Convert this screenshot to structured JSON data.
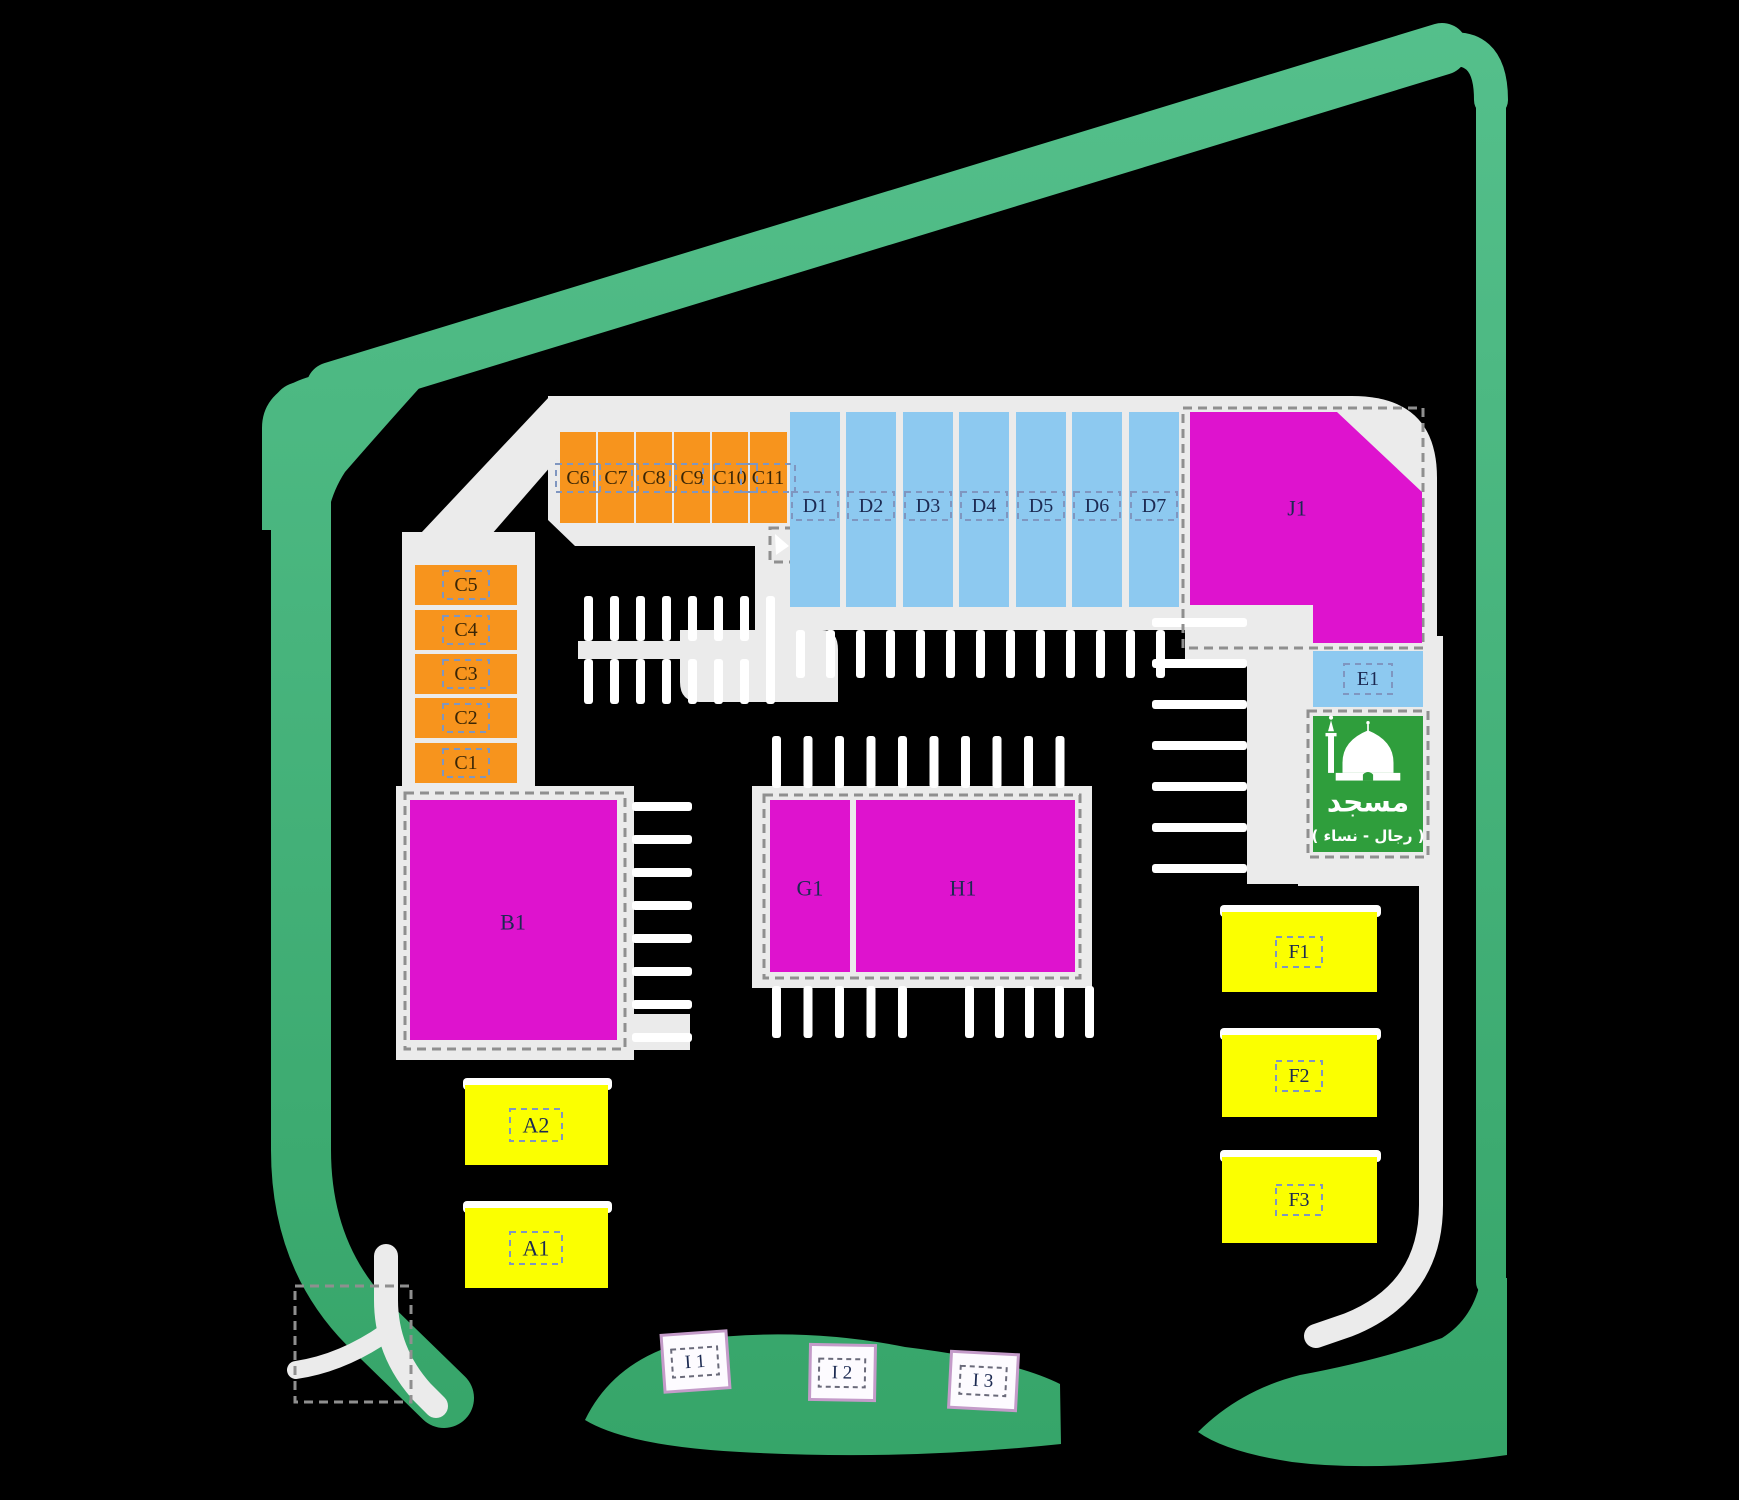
{
  "title": "Commercial plaza site plan",
  "colors": {
    "background": "#000000",
    "road": "#EBEBEB",
    "stall": "#FFFFFF",
    "green_light": "#55C08C",
    "green_dark": "#35A468",
    "unit_orange": "#F7941D",
    "unit_blue": "#8DC9F0",
    "unit_magenta": "#DE13CE",
    "unit_yellow": "#FBFF00",
    "mosque_green": "#2F9E3C",
    "kiosk_fill": "#FDFBFF",
    "kiosk_border": "#C49BC9",
    "label_dash_border": "#7F96C0",
    "kiosk_dash_border": "#6A6A7A",
    "plot_dash_border": "#8F8F8F",
    "label_text_navy": "#1C2A52",
    "label_text_brown": "#3A2606",
    "white": "#FFFFFF"
  },
  "site_plan": {
    "units": [
      {
        "id": "C6",
        "label": "C6",
        "color": "unit_orange",
        "x": 560,
        "y": 432,
        "w": 36,
        "h": 91,
        "lx": 578,
        "ly": 478,
        "box": [
          44,
          28
        ],
        "tc": "label_text_brown",
        "fs": 20
      },
      {
        "id": "C7",
        "label": "C7",
        "color": "unit_orange",
        "x": 598,
        "y": 432,
        "w": 36,
        "h": 91,
        "lx": 616,
        "ly": 478,
        "box": [
          44,
          28
        ],
        "tc": "label_text_brown",
        "fs": 20
      },
      {
        "id": "C8",
        "label": "C8",
        "color": "unit_orange",
        "x": 636,
        "y": 432,
        "w": 36,
        "h": 91,
        "lx": 654,
        "ly": 478,
        "box": [
          44,
          28
        ],
        "tc": "label_text_brown",
        "fs": 20
      },
      {
        "id": "C9",
        "label": "C9",
        "color": "unit_orange",
        "x": 674,
        "y": 432,
        "w": 36,
        "h": 91,
        "lx": 692,
        "ly": 478,
        "box": [
          44,
          28
        ],
        "tc": "label_text_brown",
        "fs": 20
      },
      {
        "id": "C10",
        "label": "C10",
        "color": "unit_orange",
        "x": 712,
        "y": 432,
        "w": 36,
        "h": 91,
        "lx": 730,
        "ly": 478,
        "box": [
          54,
          28
        ],
        "tc": "label_text_brown",
        "fs": 20
      },
      {
        "id": "C11",
        "label": "C11",
        "color": "unit_orange",
        "x": 750,
        "y": 432,
        "w": 37,
        "h": 91,
        "lx": 768,
        "ly": 478,
        "box": [
          54,
          28
        ],
        "tc": "label_text_brown",
        "fs": 20
      },
      {
        "id": "C5",
        "label": "C5",
        "color": "unit_orange",
        "x": 415,
        "y": 565,
        "w": 102,
        "h": 40,
        "lx": 466,
        "ly": 585,
        "box": [
          46,
          28
        ],
        "tc": "label_text_brown",
        "fs": 20
      },
      {
        "id": "C4",
        "label": "C4",
        "color": "unit_orange",
        "x": 415,
        "y": 610,
        "w": 102,
        "h": 40,
        "lx": 466,
        "ly": 630,
        "box": [
          46,
          28
        ],
        "tc": "label_text_brown",
        "fs": 20
      },
      {
        "id": "C3",
        "label": "C3",
        "color": "unit_orange",
        "x": 415,
        "y": 654,
        "w": 102,
        "h": 40,
        "lx": 466,
        "ly": 674,
        "box": [
          46,
          28
        ],
        "tc": "label_text_brown",
        "fs": 20
      },
      {
        "id": "C2",
        "label": "C2",
        "color": "unit_orange",
        "x": 415,
        "y": 698,
        "w": 102,
        "h": 40,
        "lx": 466,
        "ly": 718,
        "box": [
          46,
          28
        ],
        "tc": "label_text_brown",
        "fs": 20
      },
      {
        "id": "C1",
        "label": "C1",
        "color": "unit_orange",
        "x": 415,
        "y": 743,
        "w": 102,
        "h": 40,
        "lx": 466,
        "ly": 763,
        "box": [
          46,
          28
        ],
        "tc": "label_text_brown",
        "fs": 20
      },
      {
        "id": "D1",
        "label": "D1",
        "color": "unit_blue",
        "x": 790,
        "y": 412,
        "w": 50,
        "h": 195,
        "lx": 815,
        "ly": 506,
        "box": [
          46,
          28
        ],
        "tc": "label_text_navy",
        "fs": 20
      },
      {
        "id": "D2",
        "label": "D2",
        "color": "unit_blue",
        "x": 846,
        "y": 412,
        "w": 50,
        "h": 195,
        "lx": 871,
        "ly": 506,
        "box": [
          46,
          28
        ],
        "tc": "label_text_navy",
        "fs": 20
      },
      {
        "id": "D3",
        "label": "D3",
        "color": "unit_blue",
        "x": 903,
        "y": 412,
        "w": 50,
        "h": 195,
        "lx": 928,
        "ly": 506,
        "box": [
          46,
          28
        ],
        "tc": "label_text_navy",
        "fs": 20
      },
      {
        "id": "D4",
        "label": "D4",
        "color": "unit_blue",
        "x": 959,
        "y": 412,
        "w": 50,
        "h": 195,
        "lx": 984,
        "ly": 506,
        "box": [
          46,
          28
        ],
        "tc": "label_text_navy",
        "fs": 20
      },
      {
        "id": "D5",
        "label": "D5",
        "color": "unit_blue",
        "x": 1016,
        "y": 412,
        "w": 50,
        "h": 195,
        "lx": 1041,
        "ly": 506,
        "box": [
          46,
          28
        ],
        "tc": "label_text_navy",
        "fs": 20
      },
      {
        "id": "D6",
        "label": "D6",
        "color": "unit_blue",
        "x": 1072,
        "y": 412,
        "w": 50,
        "h": 195,
        "lx": 1097,
        "ly": 506,
        "box": [
          46,
          28
        ],
        "tc": "label_text_navy",
        "fs": 20
      },
      {
        "id": "D7",
        "label": "D7",
        "color": "unit_blue",
        "x": 1129,
        "y": 412,
        "w": 50,
        "h": 195,
        "lx": 1154,
        "ly": 506,
        "box": [
          46,
          28
        ],
        "tc": "label_text_navy",
        "fs": 20
      },
      {
        "id": "J1",
        "label": "J1",
        "color": "unit_magenta",
        "points": "1190,412 1337,412 1422,492 1422,643 1313,643 1313,605 1190,605",
        "lx": 1297,
        "ly": 508,
        "tc": "label_text_navy",
        "fs": 22
      },
      {
        "id": "E1",
        "label": "E1",
        "color": "unit_blue",
        "x": 1313,
        "y": 651,
        "w": 110,
        "h": 56,
        "lx": 1368,
        "ly": 679,
        "box": [
          48,
          30
        ],
        "tc": "label_text_navy",
        "fs": 20
      },
      {
        "id": "B1",
        "label": "B1",
        "color": "unit_magenta",
        "x": 410,
        "y": 800,
        "w": 207,
        "h": 240,
        "lx": 513,
        "ly": 922,
        "tc": "label_text_navy",
        "fs": 22
      },
      {
        "id": "G1",
        "label": "G1",
        "color": "unit_magenta",
        "x": 770,
        "y": 800,
        "w": 80,
        "h": 172,
        "lx": 810,
        "ly": 888,
        "tc": "label_text_navy",
        "fs": 22
      },
      {
        "id": "H1",
        "label": "H1",
        "color": "unit_magenta",
        "x": 856,
        "y": 800,
        "w": 219,
        "h": 172,
        "lx": 963,
        "ly": 888,
        "tc": "label_text_navy",
        "fs": 22
      },
      {
        "id": "A2",
        "label": "A2",
        "color": "unit_yellow",
        "x": 465,
        "y": 1085,
        "w": 143,
        "h": 80,
        "lx": 536,
        "ly": 1125,
        "box": [
          52,
          32
        ],
        "tc": "label_text_navy",
        "fs": 22,
        "highlight": true
      },
      {
        "id": "A1",
        "label": "A1",
        "color": "unit_yellow",
        "x": 465,
        "y": 1208,
        "w": 143,
        "h": 80,
        "lx": 536,
        "ly": 1248,
        "box": [
          52,
          32
        ],
        "tc": "label_text_navy",
        "fs": 22,
        "highlight": true
      },
      {
        "id": "F1",
        "label": "F1",
        "color": "unit_yellow",
        "x": 1222,
        "y": 912,
        "w": 155,
        "h": 80,
        "lx": 1299,
        "ly": 952,
        "box": [
          46,
          30
        ],
        "tc": "label_text_navy",
        "fs": 20,
        "highlight": true
      },
      {
        "id": "F2",
        "label": "F2",
        "color": "unit_yellow",
        "x": 1222,
        "y": 1035,
        "w": 155,
        "h": 82,
        "lx": 1299,
        "ly": 1076,
        "box": [
          46,
          30
        ],
        "tc": "label_text_navy",
        "fs": 20,
        "highlight": true
      },
      {
        "id": "F3",
        "label": "F3",
        "color": "unit_yellow",
        "x": 1222,
        "y": 1157,
        "w": 155,
        "h": 86,
        "lx": 1299,
        "ly": 1200,
        "box": [
          46,
          30
        ],
        "tc": "label_text_navy",
        "fs": 20,
        "highlight": true
      }
    ],
    "mosque": {
      "x": 1313,
      "y": 716,
      "w": 110,
      "h": 136,
      "label": "مسجد",
      "sublabel": "( رجال - نساء )"
    },
    "kiosks": [
      {
        "id": "I1",
        "label": "I 1",
        "x": 663,
        "y": 1333,
        "w": 65,
        "h": 57,
        "rot": -4,
        "lx": 695,
        "ly": 1362
      },
      {
        "id": "I2",
        "label": "I 2",
        "x": 810,
        "y": 1345,
        "w": 65,
        "h": 55,
        "rot": 1,
        "lx": 842,
        "ly": 1373
      },
      {
        "id": "I3",
        "label": "I 3",
        "x": 950,
        "y": 1353,
        "w": 67,
        "h": 56,
        "rot": 3,
        "lx": 983,
        "ly": 1381
      }
    ]
  }
}
